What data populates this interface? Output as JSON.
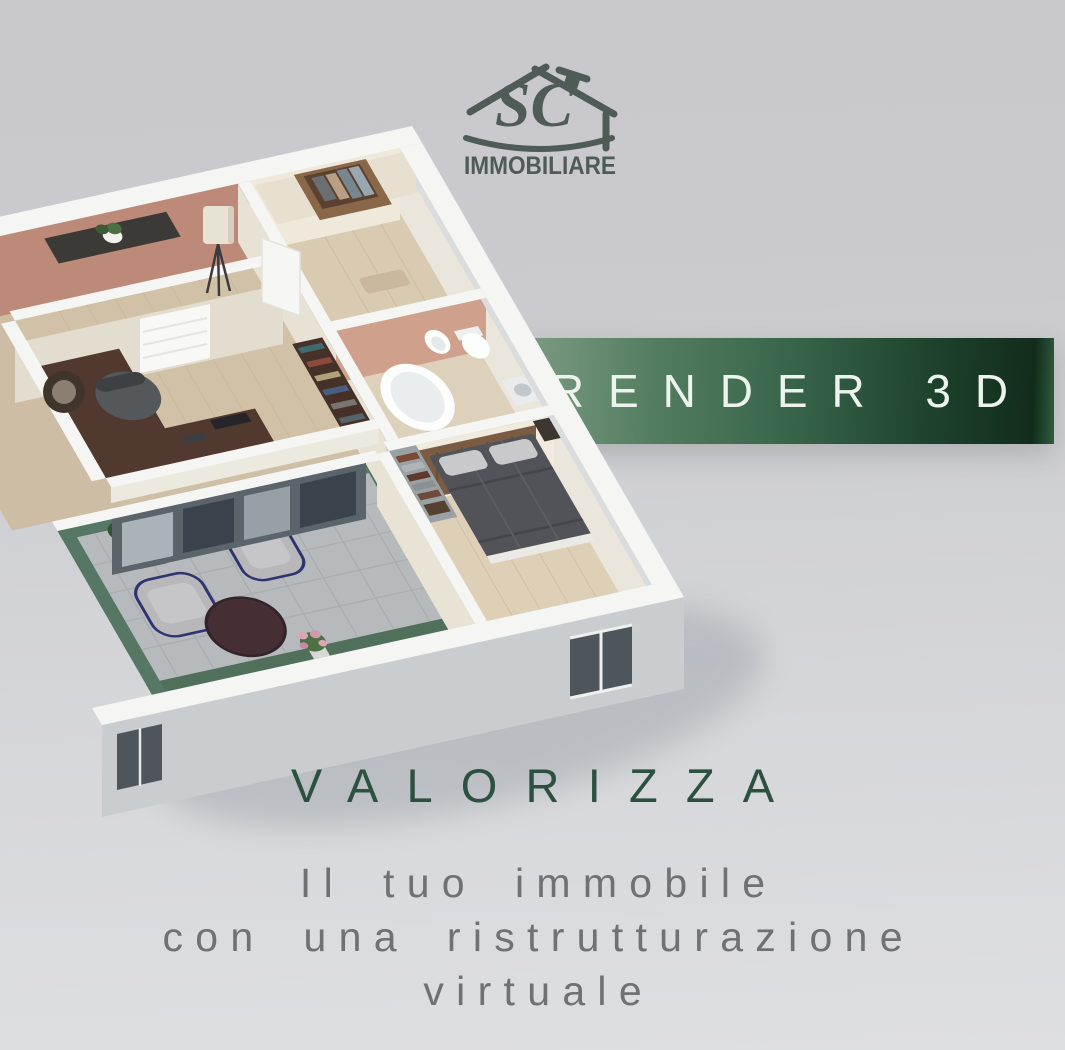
{
  "page": {
    "type": "real-estate promotional graphic"
  },
  "logo": {
    "monogram": "SC",
    "company": "IMMOBILIARE",
    "color": "#4f5b57"
  },
  "banner": {
    "label": "RENDER 3D",
    "text_color": "#edf4ee",
    "gradient": [
      "#82a089",
      "#38654a",
      "#122c1c",
      "#2f5e3d"
    ]
  },
  "headline": {
    "title": "VALORIZZA",
    "color": "#2c5141"
  },
  "subheadline": {
    "lines": [
      "Il tuo immobile",
      "con una ristrutturazione",
      "virtuale"
    ],
    "color": "#6f7173"
  },
  "floorplan": {
    "kind": "isometric 3D apartment render",
    "visible_rooms": [
      "hallway",
      "office",
      "wardrobe room",
      "bathroom",
      "bedroom",
      "terrace lounge"
    ]
  },
  "background": {
    "top": "#c7c7cc",
    "bottom": "#dedfe1"
  }
}
